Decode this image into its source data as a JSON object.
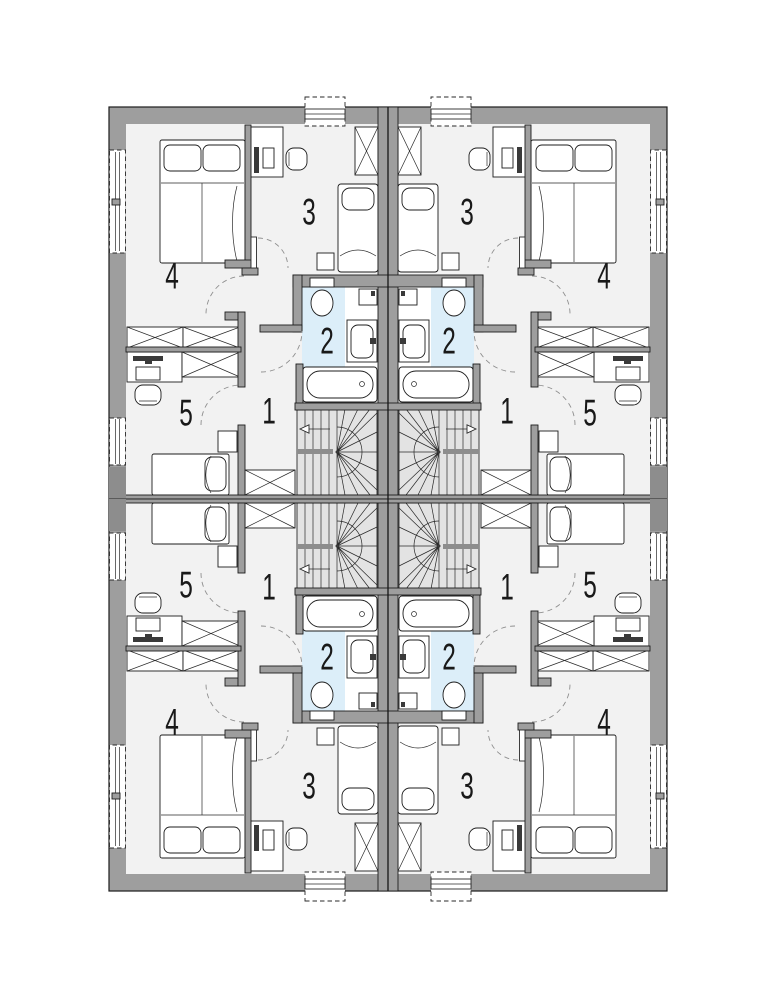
{
  "floor_plan": {
    "room_labels": [
      {
        "label": "1"
      },
      {
        "label": "2"
      },
      {
        "label": "3"
      },
      {
        "label": "4"
      },
      {
        "label": "5"
      }
    ],
    "colors": {
      "wall": "#9e9e9e",
      "wall_dark": "#8d8d8d",
      "floor": "#f2f2f2",
      "bathroom_floor": "#dceef9",
      "stair_floor": "#e3e3e3",
      "outline": "#1c1c1c",
      "background": "#ffffff"
    }
  }
}
